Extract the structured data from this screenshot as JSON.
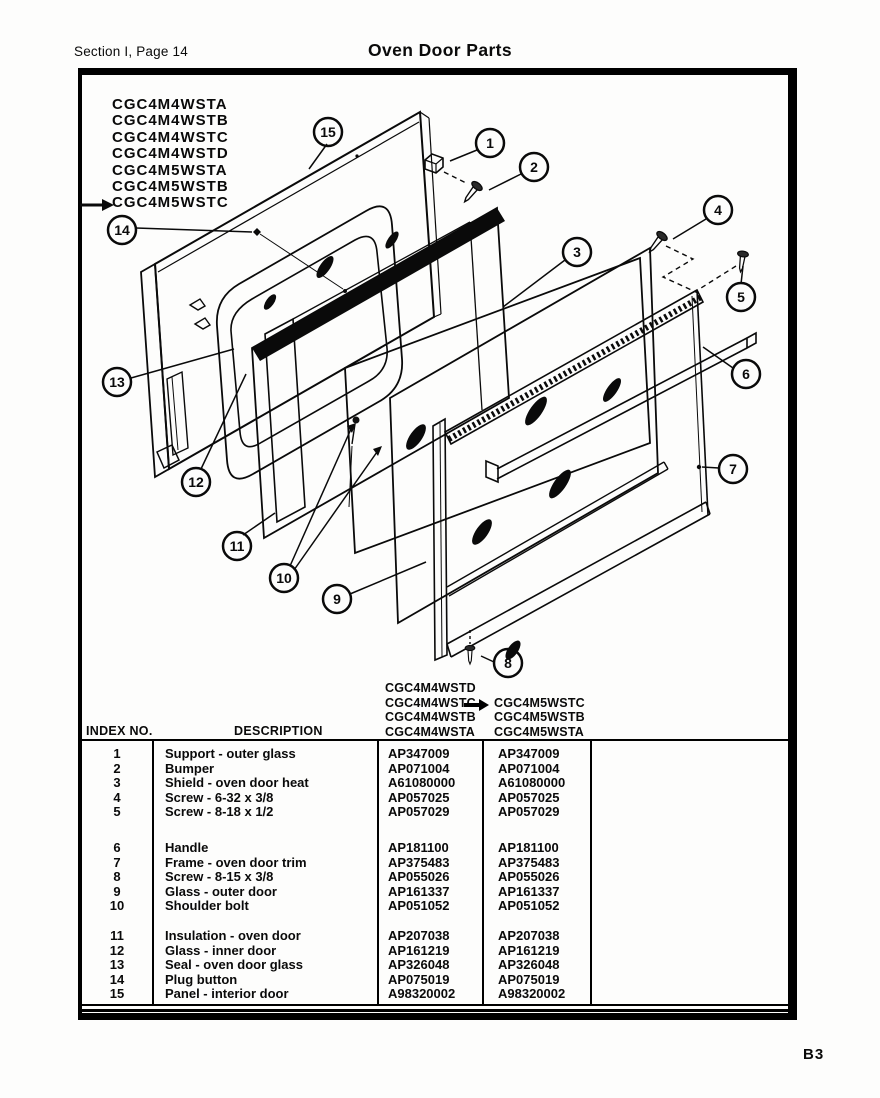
{
  "header": {
    "section_label": "Section I, Page 14",
    "title": "Oven Door Parts",
    "page_code": "B3"
  },
  "diagram": {
    "model_list": [
      "CGC4M4WSTA",
      "CGC4M4WSTB",
      "CGC4M4WSTC",
      "CGC4M4WSTD",
      "CGC4M5WSTA",
      "CGC4M5WSTB",
      "CGC4M5WSTC"
    ],
    "callouts": [
      "1",
      "2",
      "3",
      "4",
      "5",
      "6",
      "7",
      "8",
      "9",
      "10",
      "11",
      "12",
      "13",
      "14",
      "15"
    ]
  },
  "table": {
    "col_headers": {
      "index": "INDEX NO.",
      "description": "DESCRIPTION"
    },
    "model_columns": {
      "col1": [
        "CGC4M4WSTD",
        "CGC4M4WSTC",
        "CGC4M4WSTB",
        "CGC4M4WSTA"
      ],
      "col2": [
        "CGC4M5WSTC",
        "CGC4M5WSTB",
        "CGC4M5WSTA"
      ]
    },
    "groups": [
      [
        {
          "index": "1",
          "description": "Support - outer glass",
          "part1": "AP347009",
          "part2": "AP347009"
        },
        {
          "index": "2",
          "description": "Bumper",
          "part1": "AP071004",
          "part2": "AP071004"
        },
        {
          "index": "3",
          "description": "Shield - oven door heat",
          "part1": "A61080000",
          "part2": "A61080000"
        },
        {
          "index": "4",
          "description": "Screw - 6-32 x 3/8",
          "part1": "AP057025",
          "part2": "AP057025"
        },
        {
          "index": "5",
          "description": "Screw - 8-18 x 1/2",
          "part1": "AP057029",
          "part2": "AP057029"
        }
      ],
      [
        {
          "index": "6",
          "description": "Handle",
          "part1": "AP181100",
          "part2": "AP181100"
        },
        {
          "index": "7",
          "description": "Frame - oven door trim",
          "part1": "AP375483",
          "part2": "AP375483"
        },
        {
          "index": "8",
          "description": "Screw - 8-15 x 3/8",
          "part1": "AP055026",
          "part2": "AP055026"
        },
        {
          "index": "9",
          "description": "Glass - outer door",
          "part1": "AP161337",
          "part2": "AP161337"
        },
        {
          "index": "10",
          "description": "Shoulder bolt",
          "part1": "AP051052",
          "part2": "AP051052"
        }
      ],
      [
        {
          "index": "11",
          "description": "Insulation - oven door",
          "part1": "AP207038",
          "part2": "AP207038"
        },
        {
          "index": "12",
          "description": "Glass - inner door",
          "part1": "AP161219",
          "part2": "AP161219"
        },
        {
          "index": "13",
          "description": "Seal - oven door glass",
          "part1": "AP326048",
          "part2": "AP326048"
        },
        {
          "index": "14",
          "description": "Plug button",
          "part1": "AP075019",
          "part2": "AP075019"
        },
        {
          "index": "15",
          "description": "Panel - interior door",
          "part1": "A98320002",
          "part2": "A98320002"
        }
      ]
    ]
  }
}
